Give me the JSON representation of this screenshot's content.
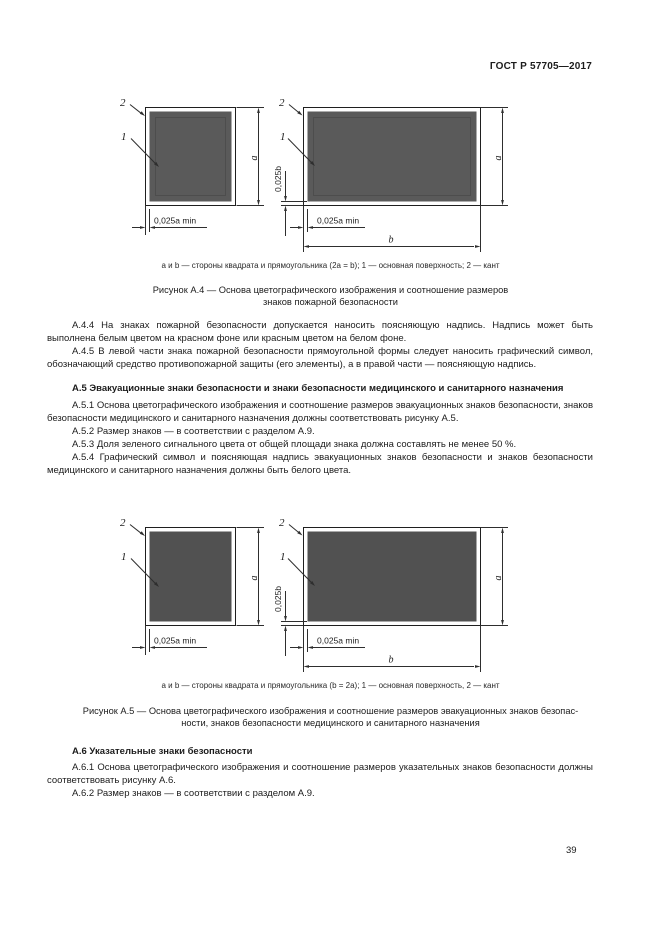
{
  "header": {
    "doc_number": "ГОСТ Р 57705—2017"
  },
  "figure_labels": {
    "callout_main_surface": "1",
    "callout_edging": "2",
    "dim_side_a": "a",
    "dim_side_b": "b",
    "dim_edging_width": "0,025a min",
    "dim_edging_height": "0,025b"
  },
  "colors": {
    "fig_a4_fill": "#5a5a5a",
    "fig_a5_fill": "#515151"
  },
  "figure_a4": {
    "legend": "а и b — стороны квадрата и прямоугольника (2a = b); 1 — основная поверхность; 2 — кант",
    "caption_line1": "Рисунок А.4 — Основа цветографического изображения и соотношение размеров",
    "caption_line2": "знаков пожарной безопасности"
  },
  "figure_a5": {
    "legend": "а и b — стороны квадрата и прямоугольника (b = 2a); 1 — основная поверхность, 2 — кант",
    "caption_line1": "Рисунок А.5 — Основа цветографического изображения и соотношение размеров эвакуационных знаков безопас-",
    "caption_line2": "ности, знаков безопасности медицинского и санитарного назначения"
  },
  "paragraphs": {
    "a_4_4": "А.4.4 На знаках пожарной безопасности допускается наносить поясняющую надпись. Надпись может быть выполнена белым цветом на красном фоне или красным цветом на белом фоне.",
    "a_4_5": "А.4.5 В левой части знака пожарной безопасности прямоугольной формы следует наносить графический символ, обозначающий средство противопожарной защиты (его элементы), а в правой части — поясняющую надпись.",
    "a_5_heading": "А.5 Эвакуационные знаки безопасности и знаки безопасности медицинского и санитарного назначения",
    "a_5_1": "А.5.1 Основа цветографического изображения и соотношение размеров эвакуационных знаков безопасности, знаков безопасности медицинского и санитарного назначения должны соответствовать рисунку А.5.",
    "a_5_2": "А.5.2 Размер знаков — в соответствии с разделом А.9.",
    "a_5_3": "А.5.3 Доля зеленого сигнального цвета от общей площади знака должна составлять не менее 50 %.",
    "a_5_4": "А.5.4 Графический символ и поясняющая надпись эвакуационных знаков безопасности и знаков безопасности медицинского и санитарного назначения должны быть белого цвета.",
    "a_6_heading": "А.6 Указательные знаки безопасности",
    "a_6_1": "А.6.1 Основа цветографического изображения и соотношение размеров указательных знаков безопасности должны соответствовать рисунку А.6.",
    "a_6_2": "А.6.2 Размер знаков — в соответствии с разделом А.9."
  },
  "footer": {
    "page_number": "39"
  }
}
